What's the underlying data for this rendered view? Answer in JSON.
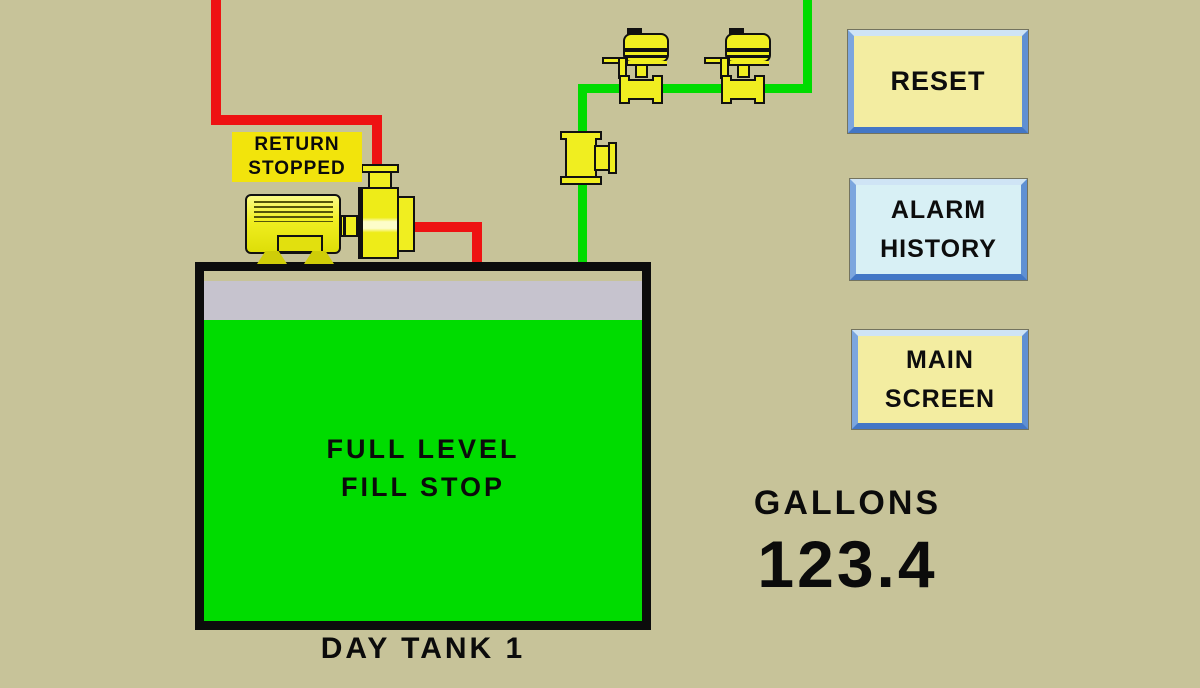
{
  "colors": {
    "background": "#c7c399",
    "return_pipe": "#ee1212",
    "supply_pipe": "#00dc00",
    "tank_fill": "#00dc00",
    "tank_headspace": "#c6c3ce",
    "equipment_yellow": "#f0ee20",
    "status_label_bg": "#f2e40c",
    "button_yellow": "#f3eda1",
    "button_cyan": "#d8f0f5",
    "button_border_blue": "#4377c6"
  },
  "pump": {
    "status_line1": "RETURN",
    "status_line2": "STOPPED"
  },
  "tank": {
    "status_line1": "FULL LEVEL",
    "status_line2": "FILL STOP",
    "name": "DAY TANK 1"
  },
  "buttons": {
    "reset": {
      "label": "RESET"
    },
    "alarm_history": {
      "line1": "ALARM",
      "line2": "HISTORY"
    },
    "main_screen": {
      "line1": "MAIN",
      "line2": "SCREEN"
    }
  },
  "readout": {
    "label": "GALLONS",
    "value": "123.4"
  }
}
